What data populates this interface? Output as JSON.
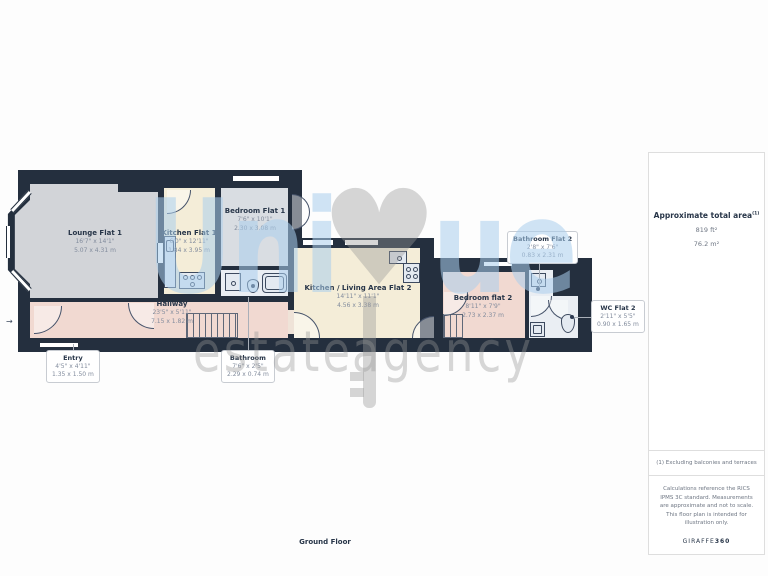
{
  "watermark": {
    "uni": "Uni",
    "ue": "ue",
    "heart": "♥",
    "estate": "estate",
    "agency": "agency"
  },
  "colors": {
    "wall": "#242f3e",
    "lounge": "#d2d4d8",
    "kitchen": "#f4edd8",
    "bedroom1": "#d9dde2",
    "hallway_pink": "#f1d9d1",
    "bathroom": "#eaeef3",
    "watermark_blue": "#aacdec",
    "watermark_gray": "#989898"
  },
  "rooms": [
    {
      "id": "lounge-flat-1",
      "name": "Lounge Flat 1",
      "imperial": "16'7\" x 14'1\"",
      "metric": "5.07 x 4.31 m"
    },
    {
      "id": "kitchen-flat-1",
      "name": "Kitchen Flat 1",
      "imperial": "6'0\" x 12'11\"",
      "metric": "1.84 x 3.95 m"
    },
    {
      "id": "bedroom-flat-1",
      "name": "Bedroom Flat 1",
      "imperial": "7'6\" x 10'1\"",
      "metric": "2.30 x 3.08 m"
    },
    {
      "id": "hallway",
      "name": "Hallway",
      "imperial": "23'5\" x 5'11\"",
      "metric": "7.15 x 1.82 m"
    },
    {
      "id": "kitchen-living-flat-2",
      "name": "Kitchen / Living Area Flat 2",
      "imperial": "14'11\" x 11'1\"",
      "metric": "4.56 x 3.38 m"
    },
    {
      "id": "bedroom-flat-2",
      "name": "Bedroom flat 2",
      "imperial": "8'11\" x 7'9\"",
      "metric": "2.73 x 2.37 m"
    }
  ],
  "callouts": [
    {
      "id": "bathroom-flat-2",
      "name": "Bathroom Flat 2",
      "imperial": "2'8\" x 7'6\"",
      "metric": "0.83 x 2.31 m"
    },
    {
      "id": "wc-flat-2",
      "name": "WC Flat 2",
      "imperial": "2'11\" x 5'5\"",
      "metric": "0.90 x 1.65 m"
    },
    {
      "id": "entry",
      "name": "Entry",
      "imperial": "4'5\" x 4'11\"",
      "metric": "1.35 x 1.50 m"
    },
    {
      "id": "bathroom",
      "name": "Bathroom",
      "imperial": "7'6\" x 2'5\"",
      "metric": "2.29 x 0.74 m"
    }
  ],
  "side_panel": {
    "title": "Approximate total area",
    "title_sup": "(1)",
    "area_ft": "819 ft²",
    "area_m": "76.2 m²",
    "footnote": "(1) Excluding balconies and terraces",
    "disclaimer": "Calculations reference the RICS IPMS 3C standard. Measurements are approximate and not to scale. This floor plan is intended for illustration only.",
    "brand": "GIRAFFE",
    "brand_bold": "360"
  },
  "footer": {
    "label": "Ground Floor"
  },
  "entry_arrow": "→"
}
